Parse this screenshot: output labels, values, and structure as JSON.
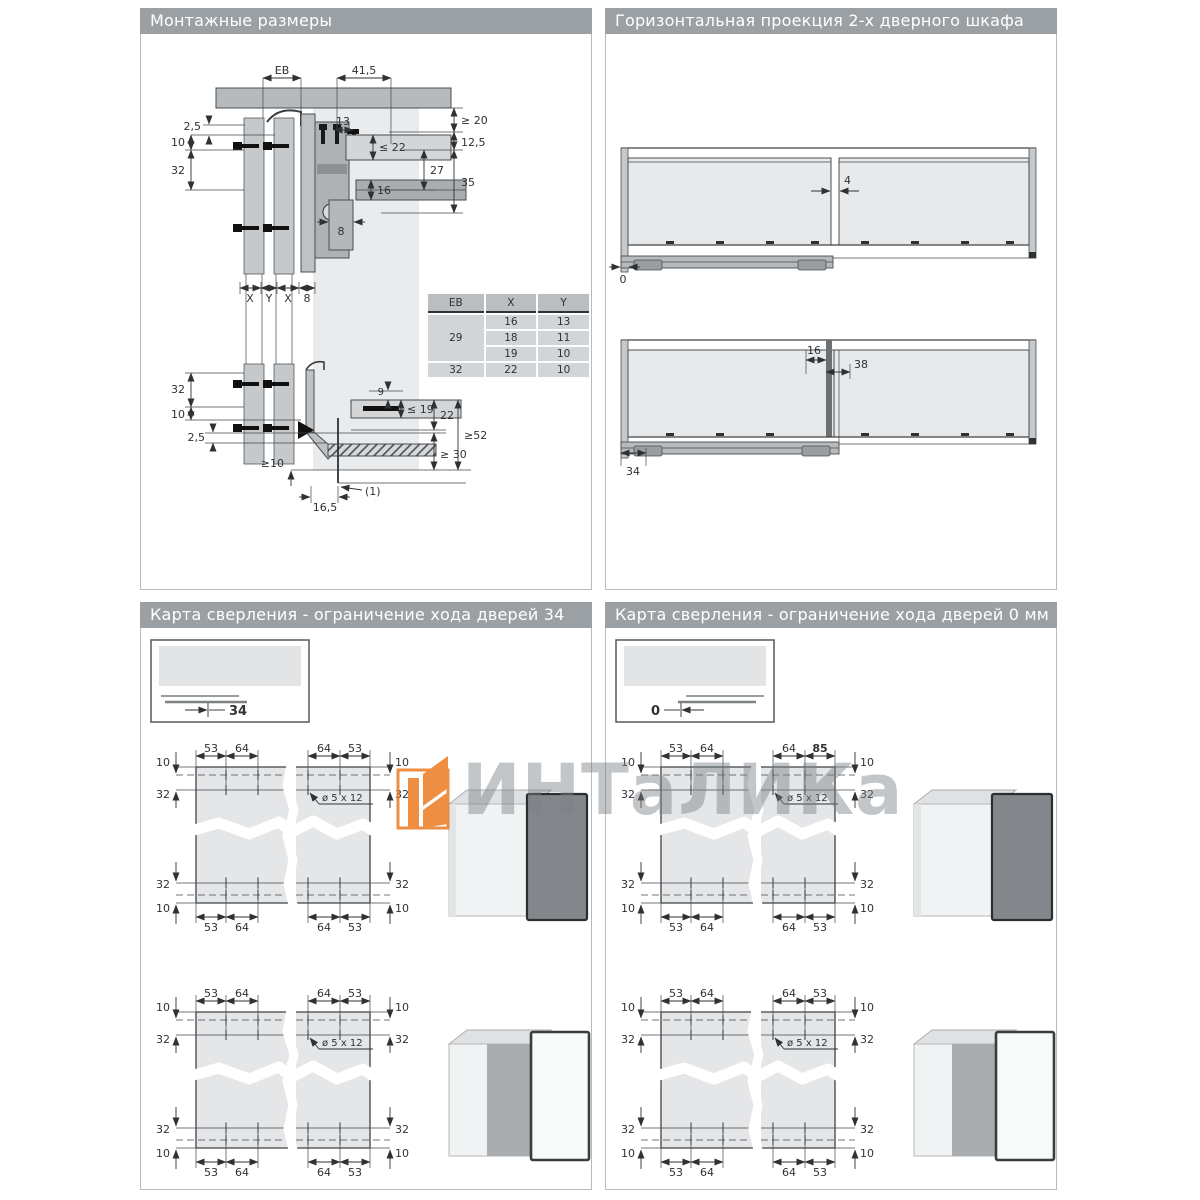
{
  "header": {
    "p1": "Монтажные размеры",
    "p2": "Горизонтальная проекция 2-х дверного шкафа",
    "p3": "Карта сверления - ограничение хода дверей 34 мм",
    "p4": "Карта сверления - ограничение хода дверей 0 мм"
  },
  "p1": {
    "dim": {
      "eb": "EB",
      "v41_5": "41,5",
      "ge20": "≥ 20",
      "v12_5": "12,5",
      "le22": "≤ 22",
      "v27": "27",
      "v35": "35",
      "v13": "13",
      "v16": "16",
      "v8": "8",
      "v2_5": "2,5",
      "v10": "10",
      "v32": "32",
      "x": "X",
      "y": "Y",
      "v9": "9",
      "le19": "≤ 19",
      "v22": "22",
      "ge52": "≥52",
      "ge30": "≥ 30",
      "ge10": "≥10",
      "v16_5": "16,5",
      "note1": "(1)"
    },
    "table": {
      "hEB": "EB",
      "hX": "X",
      "hY": "Y",
      "eb29": "29",
      "eb32": "32",
      "r1x": "16",
      "r1y": "13",
      "r2x": "18",
      "r2y": "11",
      "r3x": "19",
      "r3y": "10",
      "r4x": "22",
      "r4y": "10"
    }
  },
  "p2": {
    "dim": {
      "v4": "4",
      "v0": "0",
      "v16": "16",
      "v38": "38",
      "v34": "34"
    }
  },
  "drill": {
    "v53": "53",
    "v64": "64",
    "v85": "85",
    "v10": "10",
    "v32": "32",
    "hole": "ø 5 x 12"
  },
  "p3": {
    "inset": "34"
  },
  "p4": {
    "inset": "0"
  },
  "watermark": {
    "text": "ИНТаЛИКа"
  }
}
